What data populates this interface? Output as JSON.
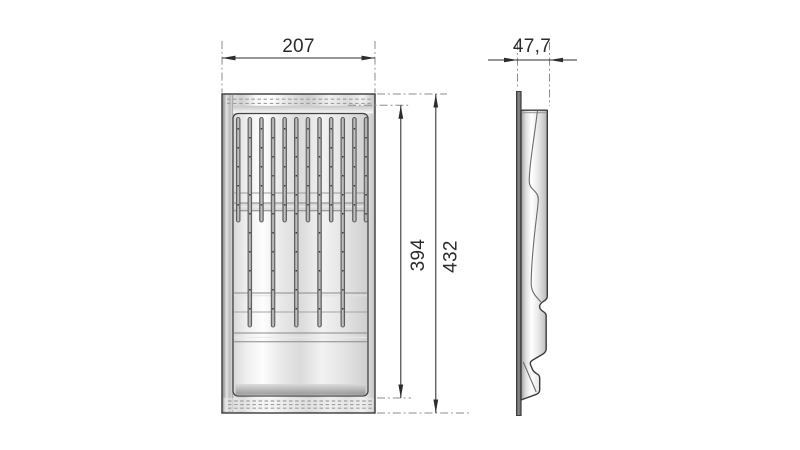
{
  "drawing": {
    "front_view": {
      "width_dim": "207",
      "inner_height_dim": "394",
      "outer_height_dim": "432",
      "slot_count": 12,
      "long_slot_indices": [
        1,
        3,
        5,
        7,
        9
      ]
    },
    "side_view": {
      "depth_dim": "47,7"
    }
  },
  "colors": {
    "outline": "#3a3a3a",
    "dimension": "#2d2d2d",
    "extension_line": "#8d8d8d",
    "metal_light": "#ffffff",
    "metal_mid": "#d9d9d9",
    "metal_dark": "#9a9a9a"
  }
}
